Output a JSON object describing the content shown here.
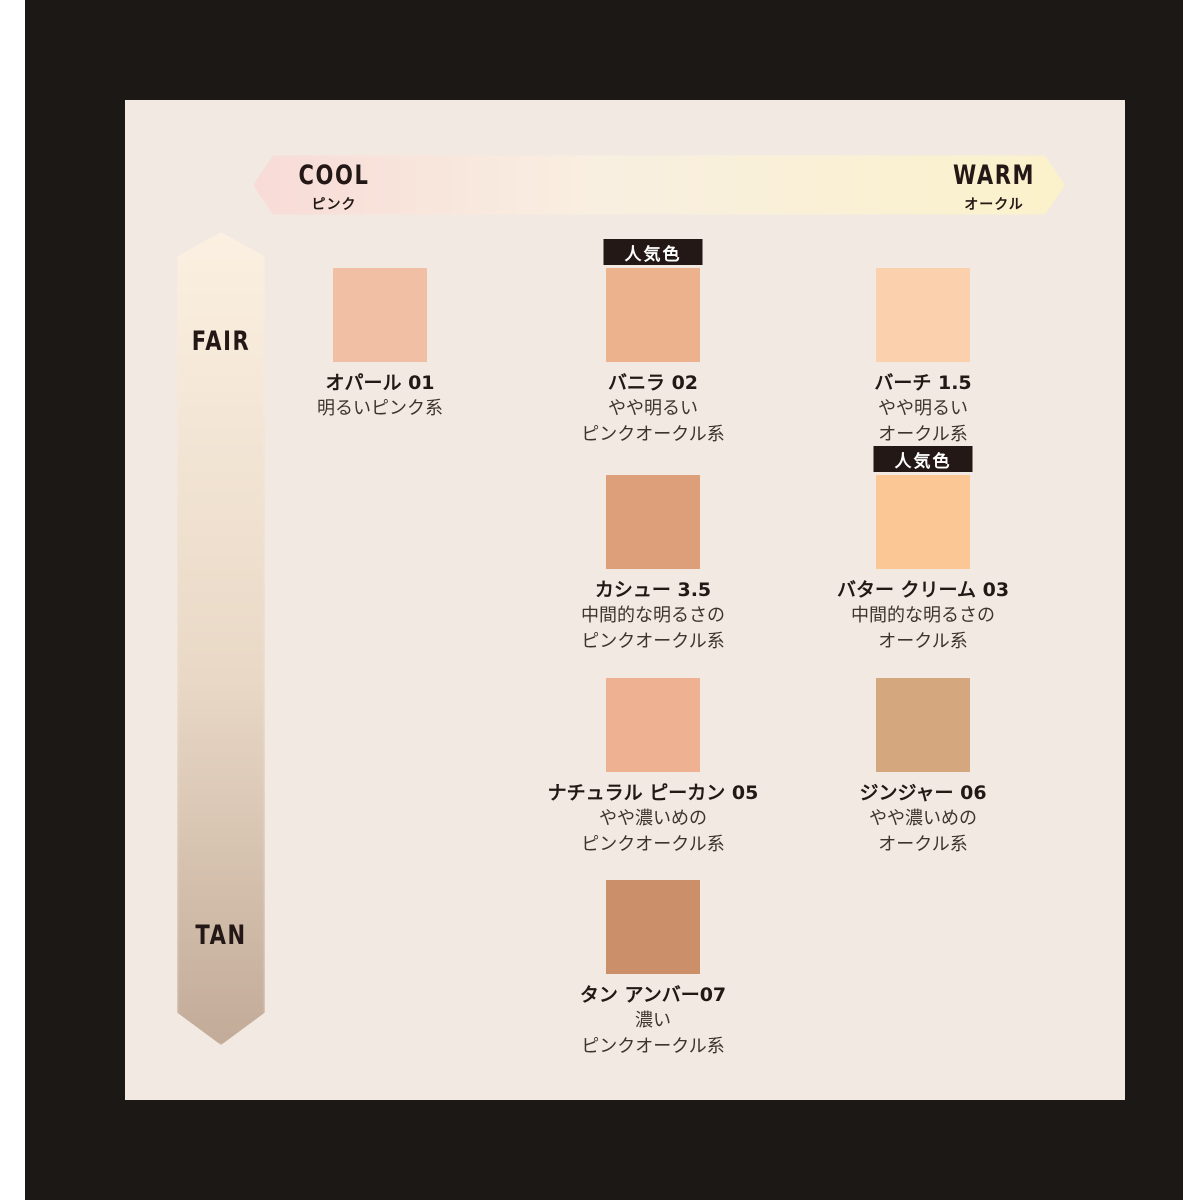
{
  "frame": {
    "outer_bg": "#ffffff",
    "border_color": "#1b1815",
    "panel_bg": "#f2eae2"
  },
  "cool_warm_axis": {
    "left_label": "COOL",
    "left_sublabel": "ピンク",
    "right_label": "WARM",
    "right_sublabel": "オークル",
    "gradient_left": "#f8dbd7",
    "gradient_mid": "#f9efe1",
    "gradient_right": "#fbf2cb"
  },
  "fair_tan_axis": {
    "top_label": "FAIR",
    "bottom_label": "TAN",
    "gradient_top": "#fbf0e1",
    "gradient_mid": "#e9d8c6",
    "gradient_bottom": "#c2ab98"
  },
  "popular_badge_label": "人気色",
  "badge_bg": "#231815",
  "badge_text_color": "#ffffff",
  "shades": [
    {
      "name": "オパール 01",
      "desc": "明るいピンク系",
      "color": "#f1bfa3",
      "popular": false
    },
    {
      "name": "バニラ 02",
      "desc": "やや明るい\nピンクオークル系",
      "color": "#ecb28e",
      "popular": true
    },
    {
      "name": "バーチ 1.5",
      "desc": "やや明るい\nオークル系",
      "color": "#fbd0ac",
      "popular": false
    },
    {
      "name": "カシュー 3.5",
      "desc": "中間的な明るさの\nピンクオークル系",
      "color": "#dd9e7a",
      "popular": false
    },
    {
      "name": "バター クリーム 03",
      "desc": "中間的な明るさの\nオークル系",
      "color": "#fac795",
      "popular": true
    },
    {
      "name": "ナチュラル ピーカン 05",
      "desc": "やや濃いめの\nピンクオークル系",
      "color": "#eeb191",
      "popular": false
    },
    {
      "name": "ジンジャー 06",
      "desc": "やや濃いめの\nオークル系",
      "color": "#d5a77e",
      "popular": false
    },
    {
      "name": "タン アンバー07",
      "desc": "濃い\nピンクオークル系",
      "color": "#cb9069",
      "popular": false
    }
  ]
}
